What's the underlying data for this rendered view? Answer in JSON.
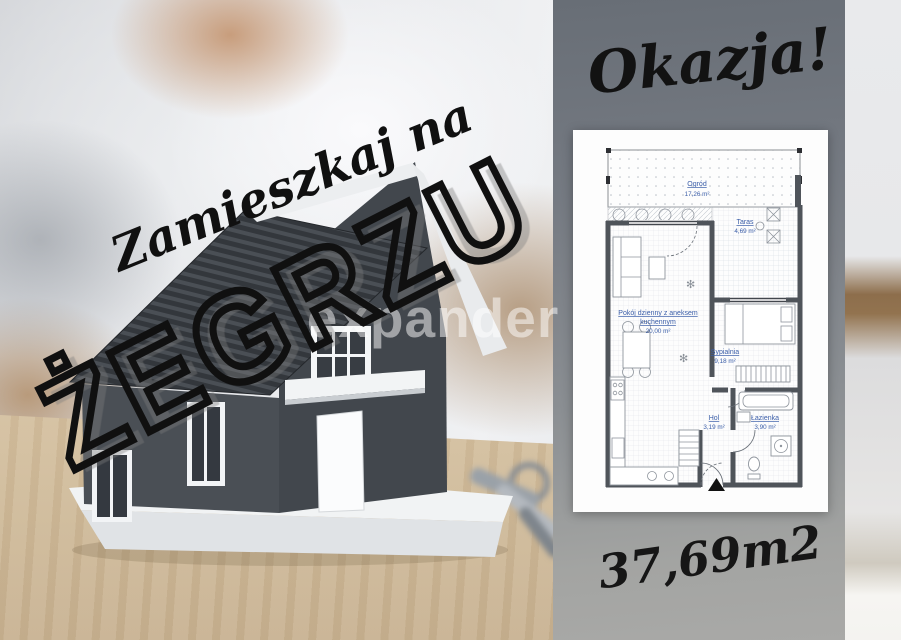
{
  "scene": {
    "headline_script": "Zamieszkaj na",
    "headline_location": "ŻEGRZU",
    "watermark": "expander"
  },
  "panel": {
    "promo": "Okazja!",
    "total_area": "37,69m2",
    "background_color": "#7d828a",
    "text_color": "#111111"
  },
  "floorplan": {
    "label_color": "#3a5da8",
    "rooms": [
      {
        "name": "Ogród",
        "area": "17,26 m²"
      },
      {
        "name": "Taras",
        "area": "4,69 m²"
      },
      {
        "name_lines": [
          "Pokój dzienny z aneksem",
          "kuchennym"
        ],
        "area": "20,00 m²"
      },
      {
        "name": "Sypialnia",
        "area": "9,18 m²"
      },
      {
        "name": "Hol",
        "area": "3,19 m²"
      },
      {
        "name": "Łazienka",
        "area": "3,90 m²"
      }
    ]
  }
}
